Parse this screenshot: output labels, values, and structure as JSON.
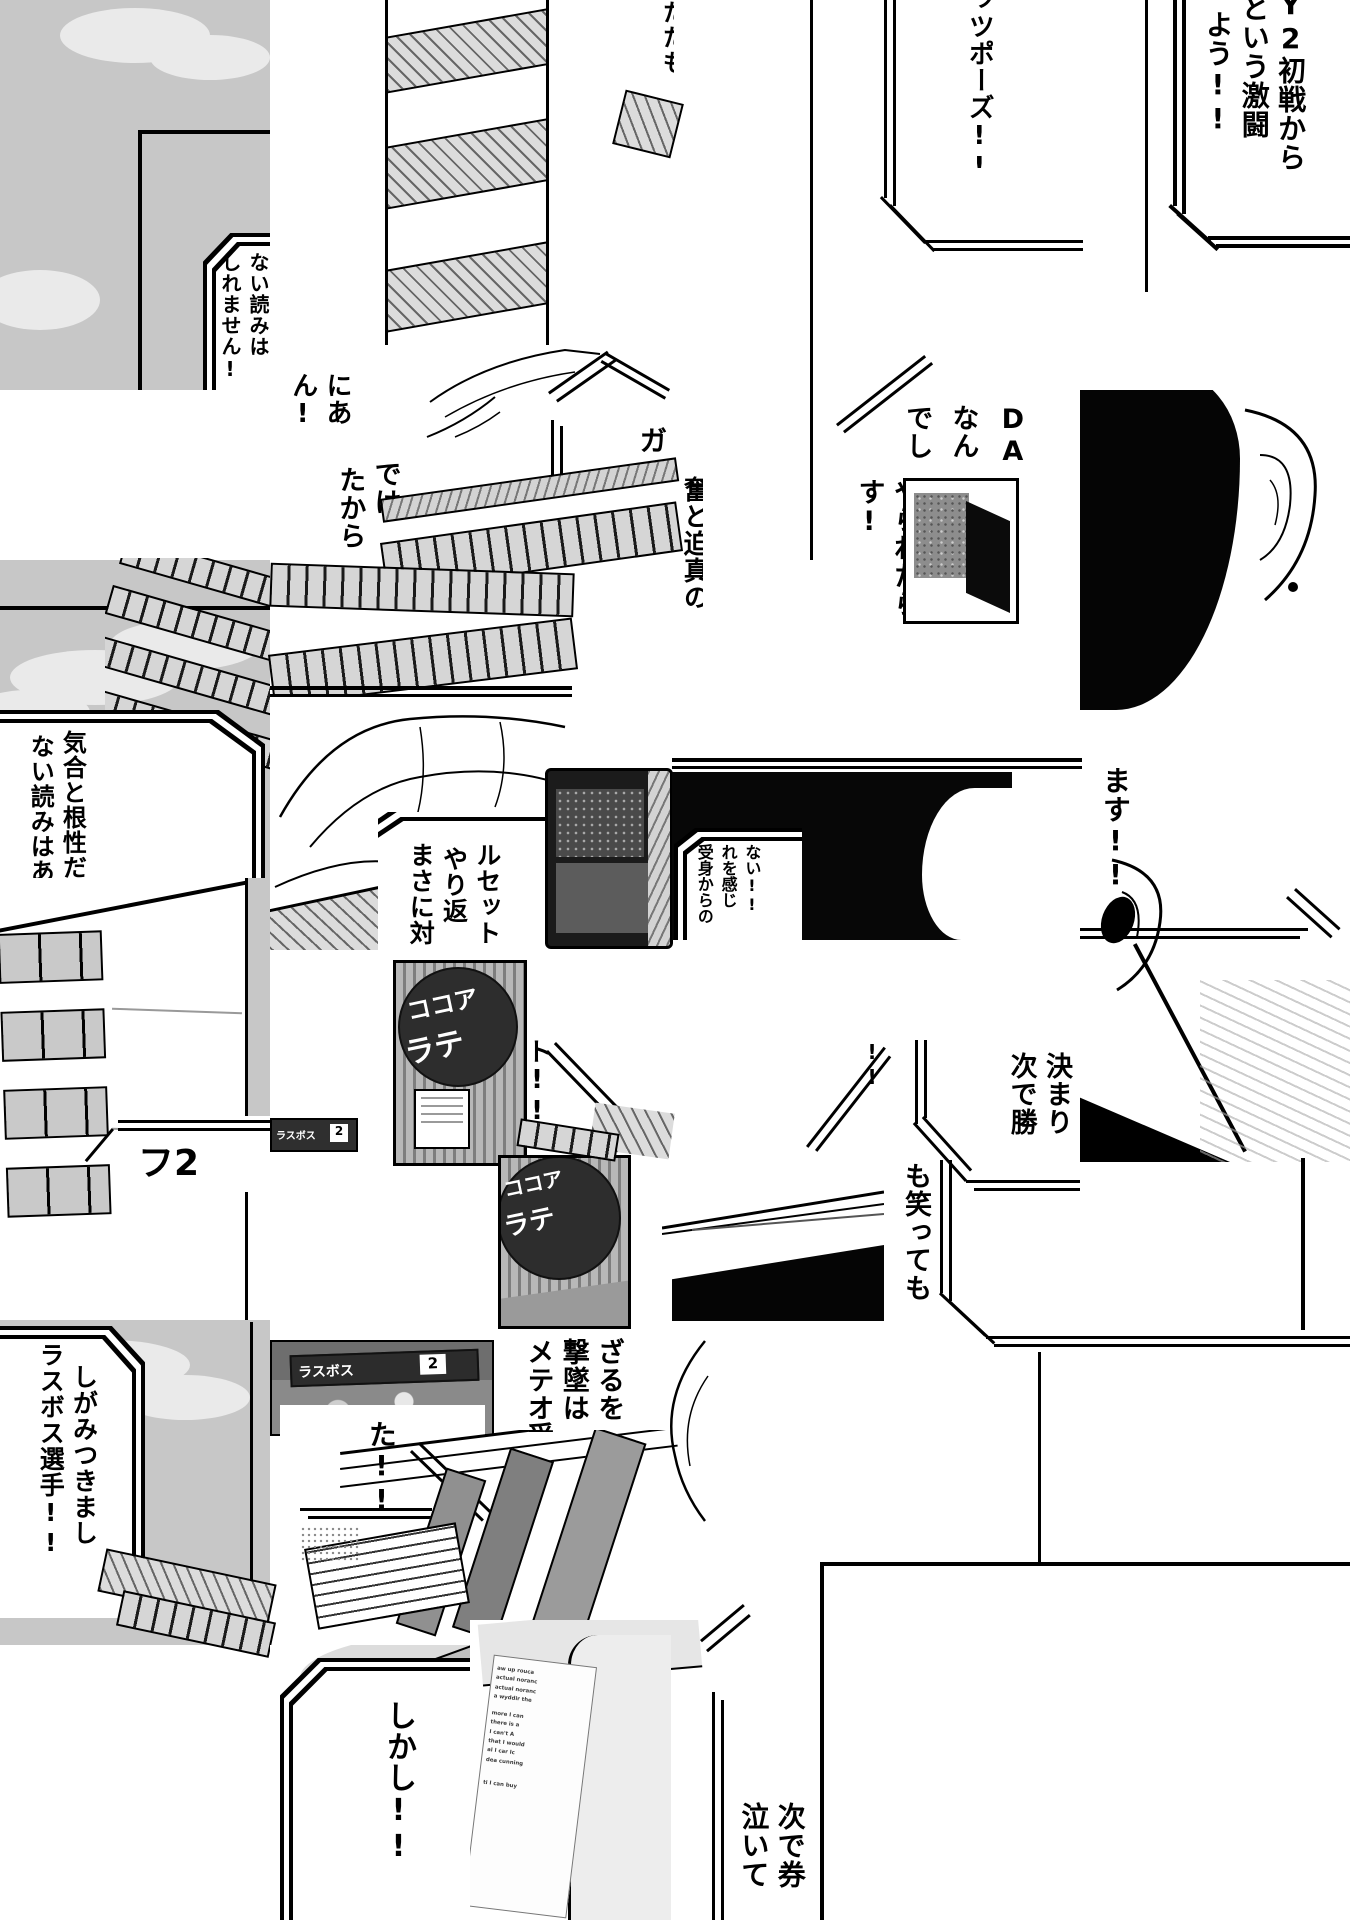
{
  "bubbles": {
    "forecast": {
      "cols": [
        "ない読みは",
        "しれません!"
      ]
    },
    "katamo": {
      "col": "たたも"
    },
    "guts_pose": {
      "col": "ッツポーズ!!"
    },
    "y2_battle": {
      "cols": [
        "Y2初戦から",
        "という激闘",
        "よう!!"
      ]
    },
    "nia": {
      "cols": [
        "にあ",
        "ん!"
      ]
    },
    "dewa": {
      "cols": [
        "では",
        "たから"
      ]
    },
    "ga": {
      "col": "ガッ"
    },
    "funto": {
      "col": "奮と迫真の"
    },
    "da_missile": {
      "cols": [
        "DA",
        "なん",
        "でし"
      ]
    },
    "yarare": {
      "cols": [
        "やられたら",
        "す!"
      ]
    },
    "kiai": {
      "cols": [
        "気合と根性だけ",
        "ない読みはあっ"
      ]
    },
    "masani": {
      "cols": [
        "まさに対2",
        "やり返",
        "ルセット!!"
      ]
    },
    "ukemi": {
      "cols": [
        "受身からの",
        "れを感じ",
        "ない!!"
      ]
    },
    "masu": {
      "col": "ます!!"
    },
    "fu2": {
      "label": "フ2"
    },
    "to_frag": {
      "col": "ト!!"
    },
    "meteo": {
      "cols": [
        "メテオ受",
        "撃墜は",
        "ざるを"
      ]
    },
    "tsugi": {
      "cols": [
        "次で勝",
        "決まり"
      ],
      "tail": "!!"
    },
    "mo_waratte": {
      "col": "も笑っても"
    },
    "ta": {
      "col": "た!!"
    },
    "lastboss": {
      "cols": [
        "ラスボス選手!!",
        "しがみつきまし"
      ]
    },
    "shikashi": {
      "col": "しかし!!"
    },
    "naite": {
      "cols": [
        "泣いて",
        "次で券"
      ]
    }
  },
  "signs": {
    "latte_left": {
      "line1": "ココア",
      "line2": "ラテ"
    },
    "latte_right": {
      "line1": "ココア",
      "line2": "ラテ"
    },
    "scoreboard": {
      "team": "ラスボス",
      "score": "2"
    },
    "scoreboard_mini": {
      "team": "ラスボス",
      "score": "2"
    }
  },
  "receipt": {
    "lines": [
      "aw up rouca",
      "actual noranc",
      "actual noranc",
      "a wyddir   the",
      "more      I can",
      "there is a",
      "I can't    A",
      "that I would",
      "al   I car   Ic",
      "dea cunning",
      "ti   I can   buy"
    ]
  }
}
